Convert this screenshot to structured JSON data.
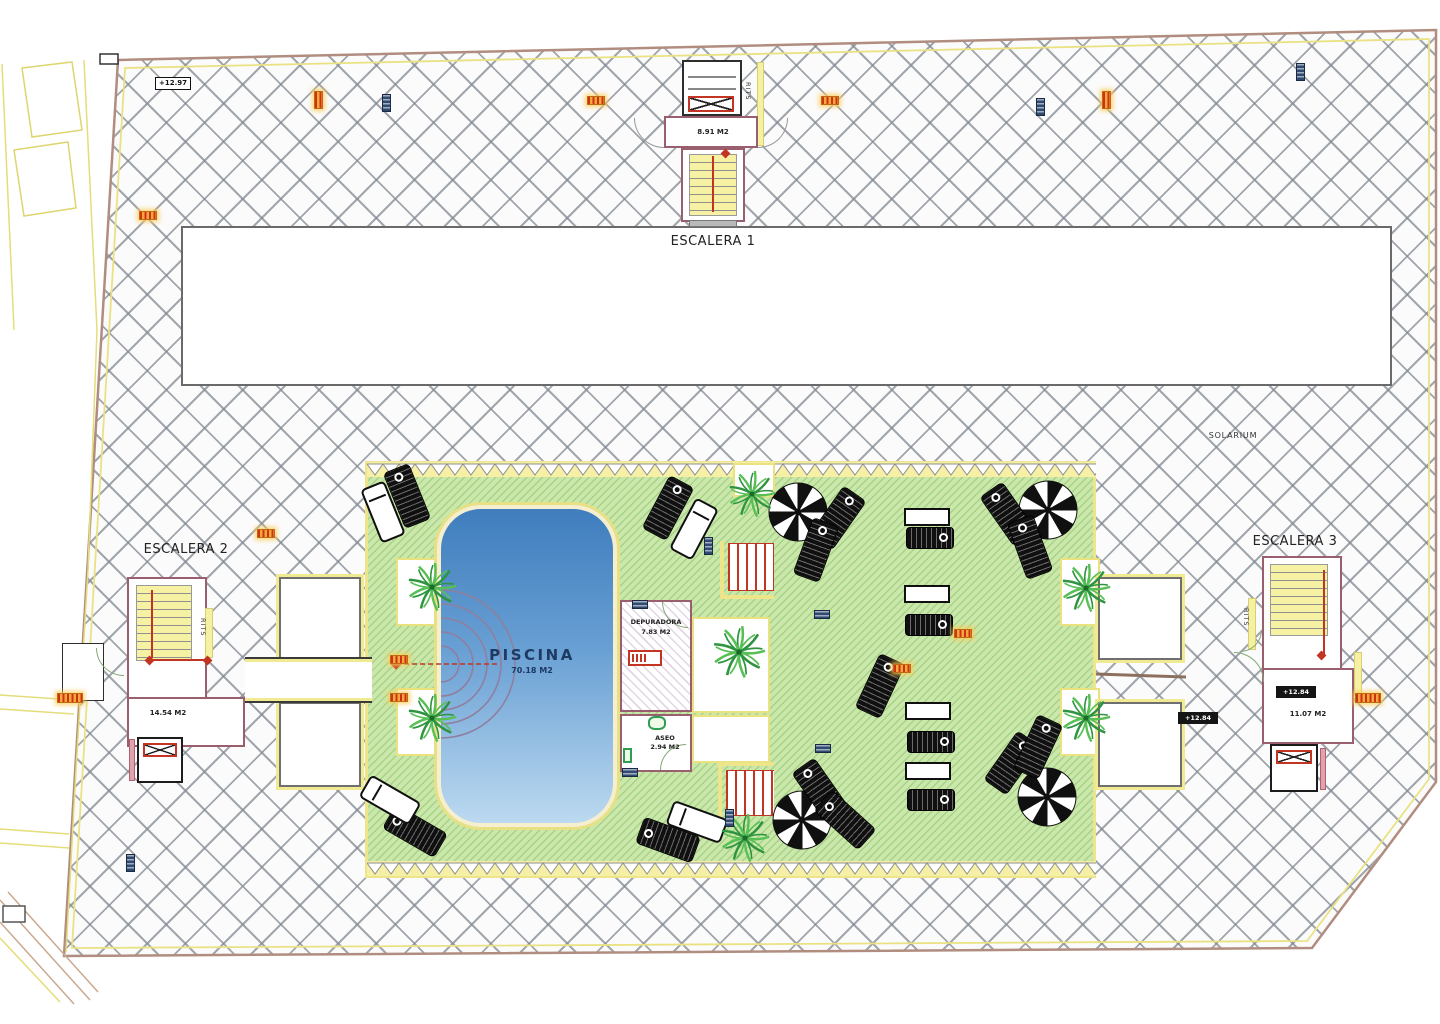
{
  "labels": {
    "escalera1": "ESCALERA 1",
    "escalera2": "ESCALERA 2",
    "escalera3": "ESCALERA 3",
    "solarium": "SOLARIUM",
    "piscina": "PISCINA",
    "piscina_area": "70.18 M2",
    "area_e1": "8.91 M2",
    "area_e2": "14.54 M2",
    "area_e3": "11.07 M2",
    "depuradora": "DEPURADORA",
    "depuradora_area": "7.83 M2",
    "aseo": "ASEO",
    "aseo_area": "2.94 M2",
    "rits": "RITS",
    "elev_top": "+12.97",
    "elev_mid": "+12.84"
  },
  "colors": {
    "pool_top": "#3f7dbd",
    "pool_bottom": "#bcd9f0",
    "deck_green": "#cbe7ab",
    "hatch_line": "#82898f",
    "boundary": "#b08d7f",
    "accent_yellow": "#eee58a",
    "wall": "#9a5f6e",
    "red": "#c23522",
    "navy_chip": "#304a72",
    "orange_chip": "#f4a83a"
  },
  "palms": [
    {
      "x": 432,
      "y": 587,
      "s": 54
    },
    {
      "x": 432,
      "y": 718,
      "s": 54
    },
    {
      "x": 752,
      "y": 494,
      "s": 52
    },
    {
      "x": 739,
      "y": 652,
      "s": 58
    },
    {
      "x": 745,
      "y": 838,
      "s": 54
    },
    {
      "x": 1086,
      "y": 588,
      "s": 54
    },
    {
      "x": 1086,
      "y": 718,
      "s": 54
    }
  ],
  "chips": [
    {
      "t": "ov",
      "x": 318,
      "y": 100
    },
    {
      "t": "nv",
      "x": 386,
      "y": 103
    },
    {
      "t": "oh",
      "x": 596,
      "y": 100
    },
    {
      "t": "oh",
      "x": 830,
      "y": 100
    },
    {
      "t": "nv",
      "x": 1040,
      "y": 107
    },
    {
      "t": "ov",
      "x": 1106,
      "y": 100
    },
    {
      "t": "nv",
      "x": 1300,
      "y": 72
    },
    {
      "t": "oh",
      "x": 148,
      "y": 215
    },
    {
      "t": "oh",
      "x": 266,
      "y": 533
    },
    {
      "t": "ob",
      "x": 70,
      "y": 698
    },
    {
      "t": "nv",
      "x": 130,
      "y": 863
    },
    {
      "t": "ob",
      "x": 1368,
      "y": 698
    },
    {
      "t": "blk",
      "x": 1198,
      "y": 718,
      "k": "elev_mid"
    },
    {
      "t": "wht",
      "x": 173,
      "y": 83,
      "k": "elev_top"
    },
    {
      "t": "nh",
      "x": 822,
      "y": 614
    },
    {
      "t": "nh",
      "x": 823,
      "y": 748
    },
    {
      "t": "nv",
      "x": 708,
      "y": 546
    },
    {
      "t": "nv",
      "x": 729,
      "y": 818
    },
    {
      "t": "oh",
      "x": 399,
      "y": 659
    },
    {
      "t": "oh",
      "x": 399,
      "y": 697
    },
    {
      "t": "oh",
      "x": 963,
      "y": 633
    },
    {
      "t": "oh",
      "x": 902,
      "y": 668
    },
    {
      "t": "nh",
      "x": 640,
      "y": 604
    },
    {
      "t": "nh",
      "x": 630,
      "y": 772
    }
  ],
  "furniture": [
    {
      "t": "umb",
      "x": 798,
      "y": 512,
      "r": 0
    },
    {
      "t": "umb",
      "x": 1048,
      "y": 510,
      "r": 0
    },
    {
      "t": "umb",
      "x": 802,
      "y": 820,
      "r": 0
    },
    {
      "t": "umb",
      "x": 1047,
      "y": 797,
      "r": 0
    },
    {
      "t": "ld",
      "x": 407,
      "y": 496,
      "r": -22
    },
    {
      "t": "ld",
      "x": 668,
      "y": 508,
      "r": 28
    },
    {
      "t": "ld",
      "x": 838,
      "y": 518,
      "r": 35
    },
    {
      "t": "ld",
      "x": 816,
      "y": 550,
      "r": 20
    },
    {
      "t": "ld",
      "x": 1008,
      "y": 514,
      "r": -35
    },
    {
      "t": "ld",
      "x": 1030,
      "y": 547,
      "r": -20
    },
    {
      "t": "ld",
      "x": 880,
      "y": 686,
      "r": 25
    },
    {
      "t": "ld",
      "x": 820,
      "y": 790,
      "r": -35
    },
    {
      "t": "ld",
      "x": 845,
      "y": 820,
      "r": -48
    },
    {
      "t": "ld",
      "x": 1012,
      "y": 763,
      "r": 35
    },
    {
      "t": "ld",
      "x": 1038,
      "y": 747,
      "r": 25
    },
    {
      "t": "ld",
      "x": 415,
      "y": 831,
      "r": -60
    },
    {
      "t": "ld",
      "x": 668,
      "y": 840,
      "r": -70
    },
    {
      "t": "lw",
      "x": 383,
      "y": 512,
      "r": -22
    },
    {
      "t": "lw",
      "x": 694,
      "y": 529,
      "r": 28
    },
    {
      "t": "lw",
      "x": 390,
      "y": 800,
      "r": -60
    },
    {
      "t": "lw",
      "x": 697,
      "y": 822,
      "r": -70
    },
    {
      "t": "ldh",
      "x": 930,
      "y": 538,
      "r": 0
    },
    {
      "t": "ldh",
      "x": 929,
      "y": 625,
      "r": 0
    },
    {
      "t": "ldh",
      "x": 931,
      "y": 742,
      "r": 0
    },
    {
      "t": "ldh",
      "x": 931,
      "y": 800,
      "r": 0
    },
    {
      "t": "tbl",
      "x": 927,
      "y": 517,
      "r": 0
    },
    {
      "t": "tbl",
      "x": 927,
      "y": 594,
      "r": 0
    },
    {
      "t": "tbl",
      "x": 928,
      "y": 711,
      "r": 0
    },
    {
      "t": "tbl",
      "x": 928,
      "y": 771,
      "r": 0
    }
  ]
}
